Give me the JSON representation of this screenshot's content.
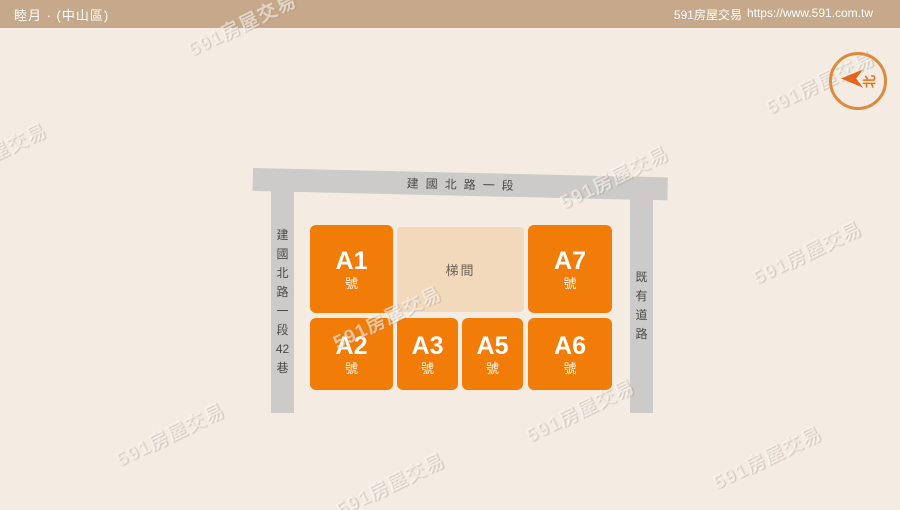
{
  "header": {
    "title": "睦月 · (中山區)",
    "brand": "591房屋交易",
    "url": "https://www.591.com.tw"
  },
  "compass": {
    "north_label": "北"
  },
  "site_plan": {
    "top_road": {
      "name": "建國北路一段"
    },
    "left_road": {
      "name": "建國北路一段42巷",
      "chars": [
        "建",
        "國",
        "北",
        "路",
        "一",
        "段",
        "42",
        "巷"
      ]
    },
    "right_road": {
      "name": "既有道路",
      "chars": [
        "既",
        "有",
        "道",
        "路"
      ]
    },
    "stairwell": {
      "label": "梯間"
    },
    "units": [
      {
        "id": "A1",
        "label": "A1",
        "suffix": "號"
      },
      {
        "id": "A7",
        "label": "A7",
        "suffix": "號"
      },
      {
        "id": "A2",
        "label": "A2",
        "suffix": "號"
      },
      {
        "id": "A3",
        "label": "A3",
        "suffix": "號"
      },
      {
        "id": "A5",
        "label": "A5",
        "suffix": "號"
      },
      {
        "id": "A6",
        "label": "A6",
        "suffix": "號"
      }
    ]
  },
  "watermark": {
    "text": "591房屋交易"
  },
  "colors": {
    "header_bg": "#c6a88a",
    "page_bg": "#f4ece3",
    "unit_orange": "#f27c08",
    "stairwell_bg": "#f2d9bc",
    "stairwell_text": "#6e6458",
    "road_gray": "#cccbc9",
    "road_text": "#4c4a47",
    "compass_ring": "#dd8a3c",
    "compass_orange": "#e2741c"
  }
}
